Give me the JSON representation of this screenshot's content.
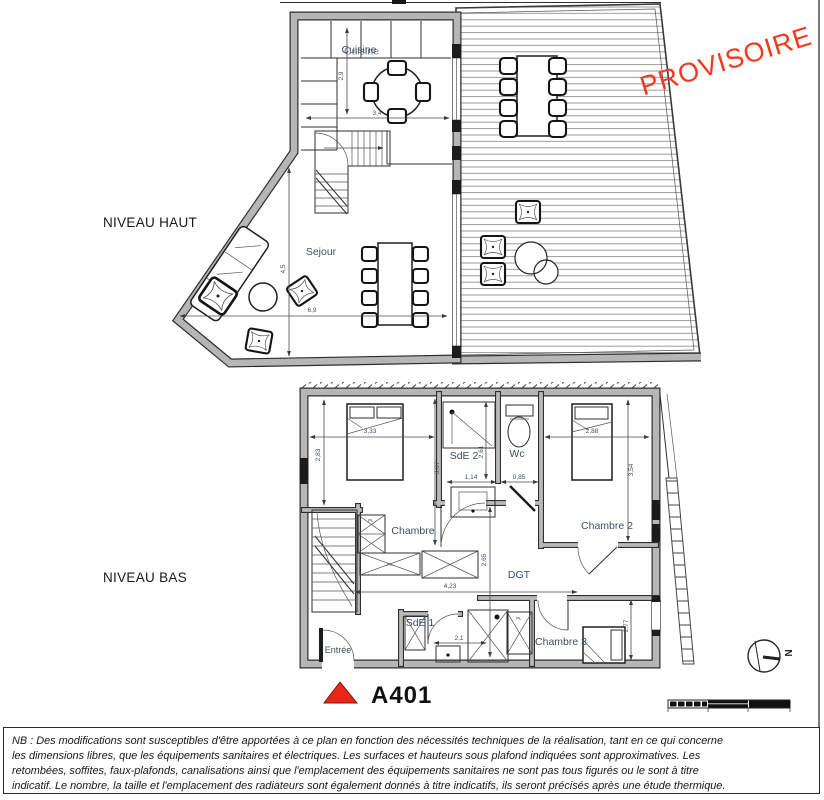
{
  "colors": {
    "stamp_red": "#f5391f",
    "marker_red": "#e6271a",
    "wall_gray": "#b6b6b6",
    "label_blue": "#3d4e63"
  },
  "stamp_text": "PROVISOIRE",
  "levels": {
    "upper": "NIVEAU HAUT",
    "lower": "NIVEAU BAS"
  },
  "apartment": {
    "code": "A401"
  },
  "compass": {
    "north": "N"
  },
  "upper_plan": {
    "rooms": {
      "cuisine": "Cuisine",
      "sejour": "Sejour"
    },
    "dims": {
      "cuisine_h": "2,9",
      "cuisine_w": "3,4",
      "sejour_h": "4,5",
      "sejour_w": "6,9"
    }
  },
  "lower_plan": {
    "rooms": {
      "chambre1": "Chambre",
      "sde2": "SdE 2",
      "wc": "Wc",
      "chambre2": "Chambre 2",
      "dgt": "DGT",
      "sde1": "SdE 1",
      "chambre3": "Chambre 3",
      "entree": "Entrée"
    },
    "dims": {
      "c1_w": "3,33",
      "c1_h": "2,83",
      "mid_h": "3,07",
      "sde2_h": "2,61",
      "sde2_w": "1,14",
      "wc_w": "0,85",
      "c2_w": "2,88",
      "c2_h": "3,54",
      "dgt_w": "4,23",
      "dgt_h": "2,65",
      "sde1_w": "2,1",
      "right_h": "2,77"
    },
    "closet_label": "PL"
  },
  "note": {
    "lines": [
      "NB : Des modifications sont susceptibles d'être apportées à ce plan en fonction des nécessités techniques de la réalisation,  tant en ce qui concerne",
      "les dimensions libres, que les équipements sanitaires et électriques. Les surfaces et hauteurs sous plafond indiquées sont approximatives. Les",
      "retombées, soffites, faux-plafonds, canalisations ainsi que l'emplacement des équipements sanitaires ne sont pas tous figurés ou le sont à titre",
      "indicatif. Le nombre, la taille et l'emplacement des radiateurs sont également donnés à titre indicatifs, ils seront précisés après une étude thermique."
    ]
  }
}
